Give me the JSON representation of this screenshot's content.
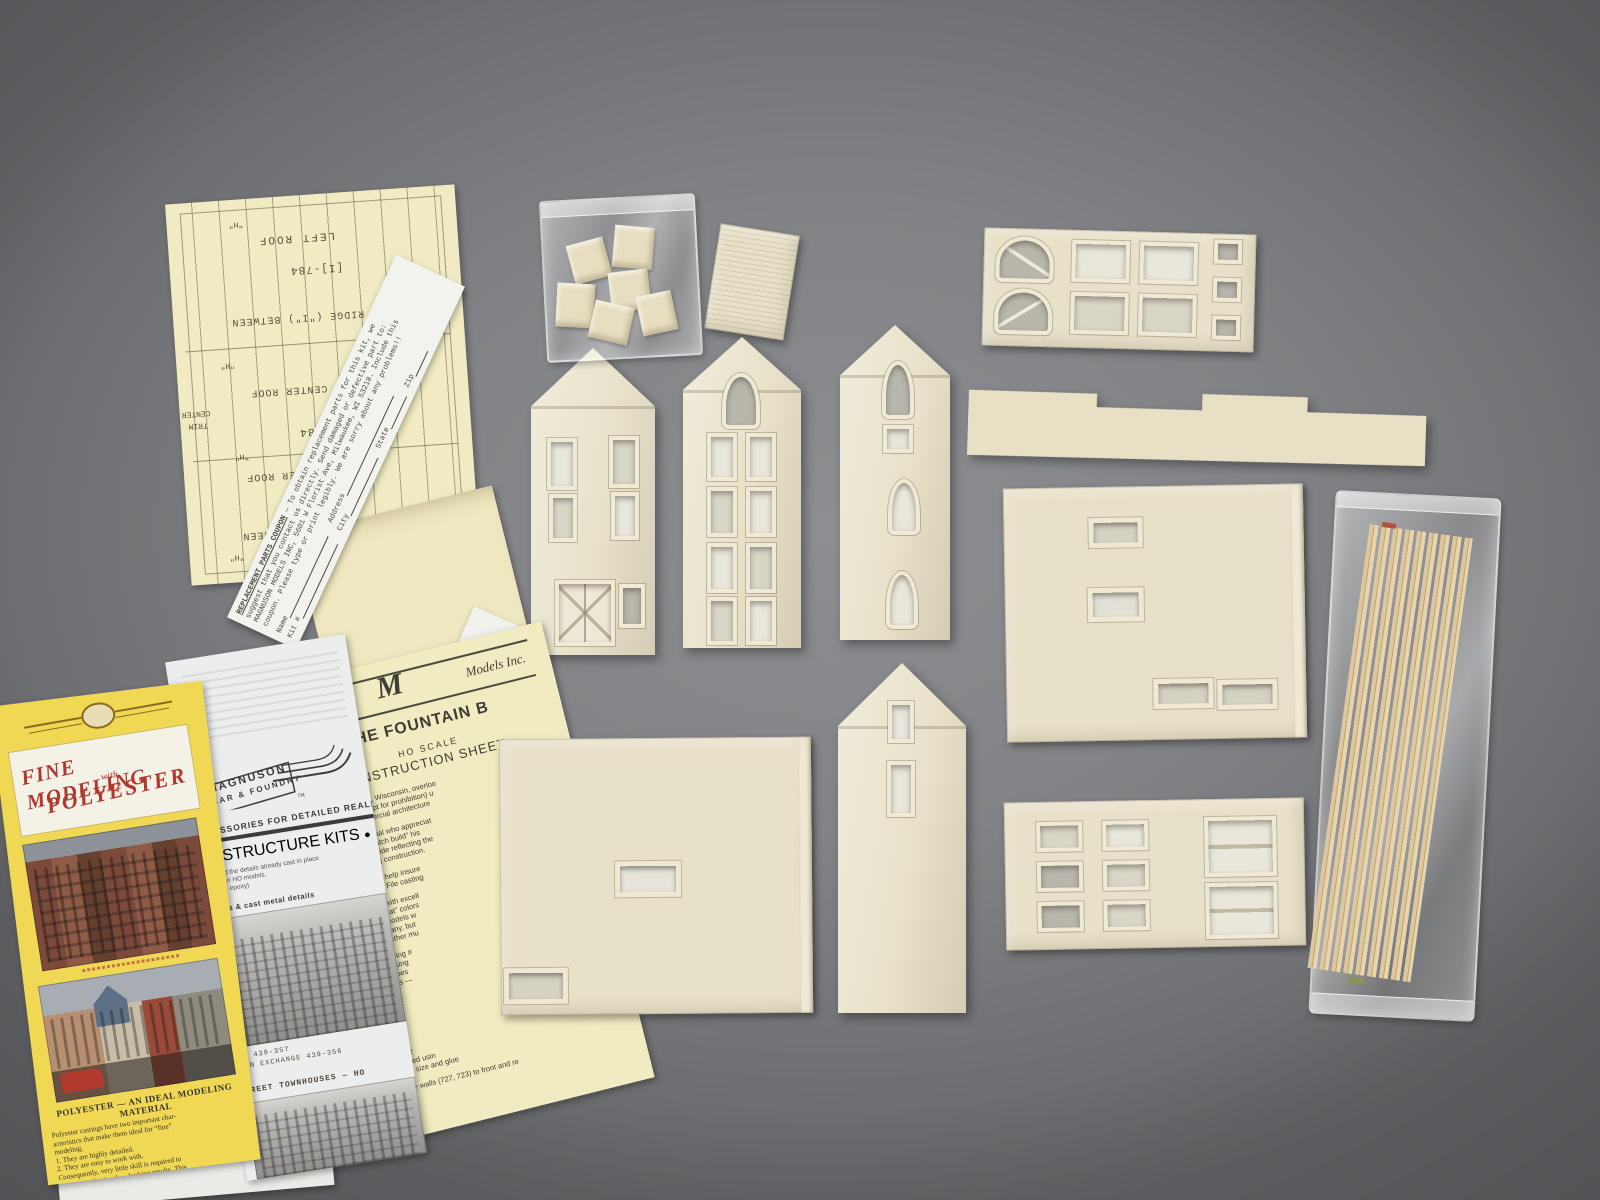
{
  "colors": {
    "background_gray": "#85868a",
    "resin_cream": "#e8e1c9",
    "paper_yellow": "#f0ebc2",
    "paper_white": "#ececea",
    "brochure_yellow": "#f0d855",
    "script_red": "#b0392f",
    "typewriter_ink": "#4c493a",
    "wood_tan": "#d8c193"
  },
  "template_sheet": {
    "label_left_roof": "LEFT ROOF",
    "label_part_a": "[I]-784",
    "label_ridge_a": "RIDGE (\"I\") BETWEEN",
    "label_left_center": "LEFT CENTER ROOF",
    "label_center": "CENTER",
    "label_trim": "TRIM",
    "label_part_b": "[I] 784",
    "label_right_center": "RIGHT CENTER ROOF",
    "label_ridge_b": "RIDGE (\"I\") BETWEEN",
    "label_roof_partial": "ROOF",
    "mark_h": "\"H\""
  },
  "coupon": {
    "heading": "REPLACEMENT PARTS COUPON",
    "line1_rest": " — To obtain replacement parts for this kit, we",
    "line2": "suggest that you contact us directly.  Send damaged or defective part to:",
    "line3": "MAGNUSON MODELS INC, 5601 W Florist Ave, Milwaukee, WI 53218.  Include this",
    "line4": "coupon.  Please type or print legibly.  We are sorry about any problems!!",
    "field_name": "Name",
    "field_kit": "Kit #",
    "field_address": "Address",
    "field_city": "City",
    "field_state": "State",
    "field_zip": "Zip"
  },
  "instruction_sheet": {
    "brand_script": "Magnuson",
    "brand_rest": "Models Inc.",
    "title": "— THE FOUNTAIN B",
    "scale": "HO SCALE",
    "subtitle": "INSTRUCTION SHEET",
    "p1": [
      "Fountain City, Wisconsin, overloo",
      "eration (except for prohibition) u",
      "torian commercial architecture"
    ],
    "p2": [
      "r the individual who appreciat",
      "time to “scratch build” his",
      "source of pride reflecting the",
      "fore starting construction."
    ],
    "p3": [
      "is point will help insure",
      "n castings. File casting"
    ],
    "p4": [
      "nd paints with excell",
      "rts. Use “flat” colors",
      "liminary models w",
      "the company, but",
      "t and weather mu"
    ],
    "p5": [
      "see drawing #",
      "to 721 using",
      "epoxy does",
      "tion walls —"
    ],
    "p6": [
      "d on the",
      "all exte",
      "with a f",
      "We u",
      "“Gr"
    ],
    "p7": [
      "part 72",
      "fastened usin",
      "Cut to size and glue"
    ],
    "p8": [
      "e side walls (727, 723) to front and re"
    ]
  },
  "white_brochure": {
    "brand_top": "MAGNUSON",
    "brand_bottom": "CAR & FOUNDRY",
    "trademark": "TM",
    "tagline": "ACCESSORIES FOR DETAILED REALISM",
    "title": "\"B\" STRUCTURE KITS",
    "bullet": "●",
    "sub_lines": [
      "that hold the details already cast in place",
      "on newer HO models.",
      "(include epoxy)"
    ],
    "caption_walls": "walls & cast metal details",
    "caption_bank": "BANK  439-357",
    "caption_exchange": "GRAIN EXCHANGE  439-356",
    "caption_townhouses": "STREET TOWNHOUSES — HO"
  },
  "yellow_brochure": {
    "title_top": "FINE MODELING",
    "title_with": "with",
    "title_bottom": "POLYESTER",
    "heading": "POLYESTER — AN IDEAL MODELING",
    "heading2": "MATERIAL",
    "body": [
      "Polyester castings have two important char-",
      "acteristics that make them ideal for “fine”",
      "modeling.",
      "  1. They are highly detailed.",
      "  2. They are easy to work with.",
      "Consequently, very little skill is required to",
      "achieve professional — looking results. This",
      "article contains general information about",
      "MASONRY buildings (circa 1870—1920) and",
      "is intended to help you assemble, paint, and",
      "weather a polyester building."
    ]
  }
}
